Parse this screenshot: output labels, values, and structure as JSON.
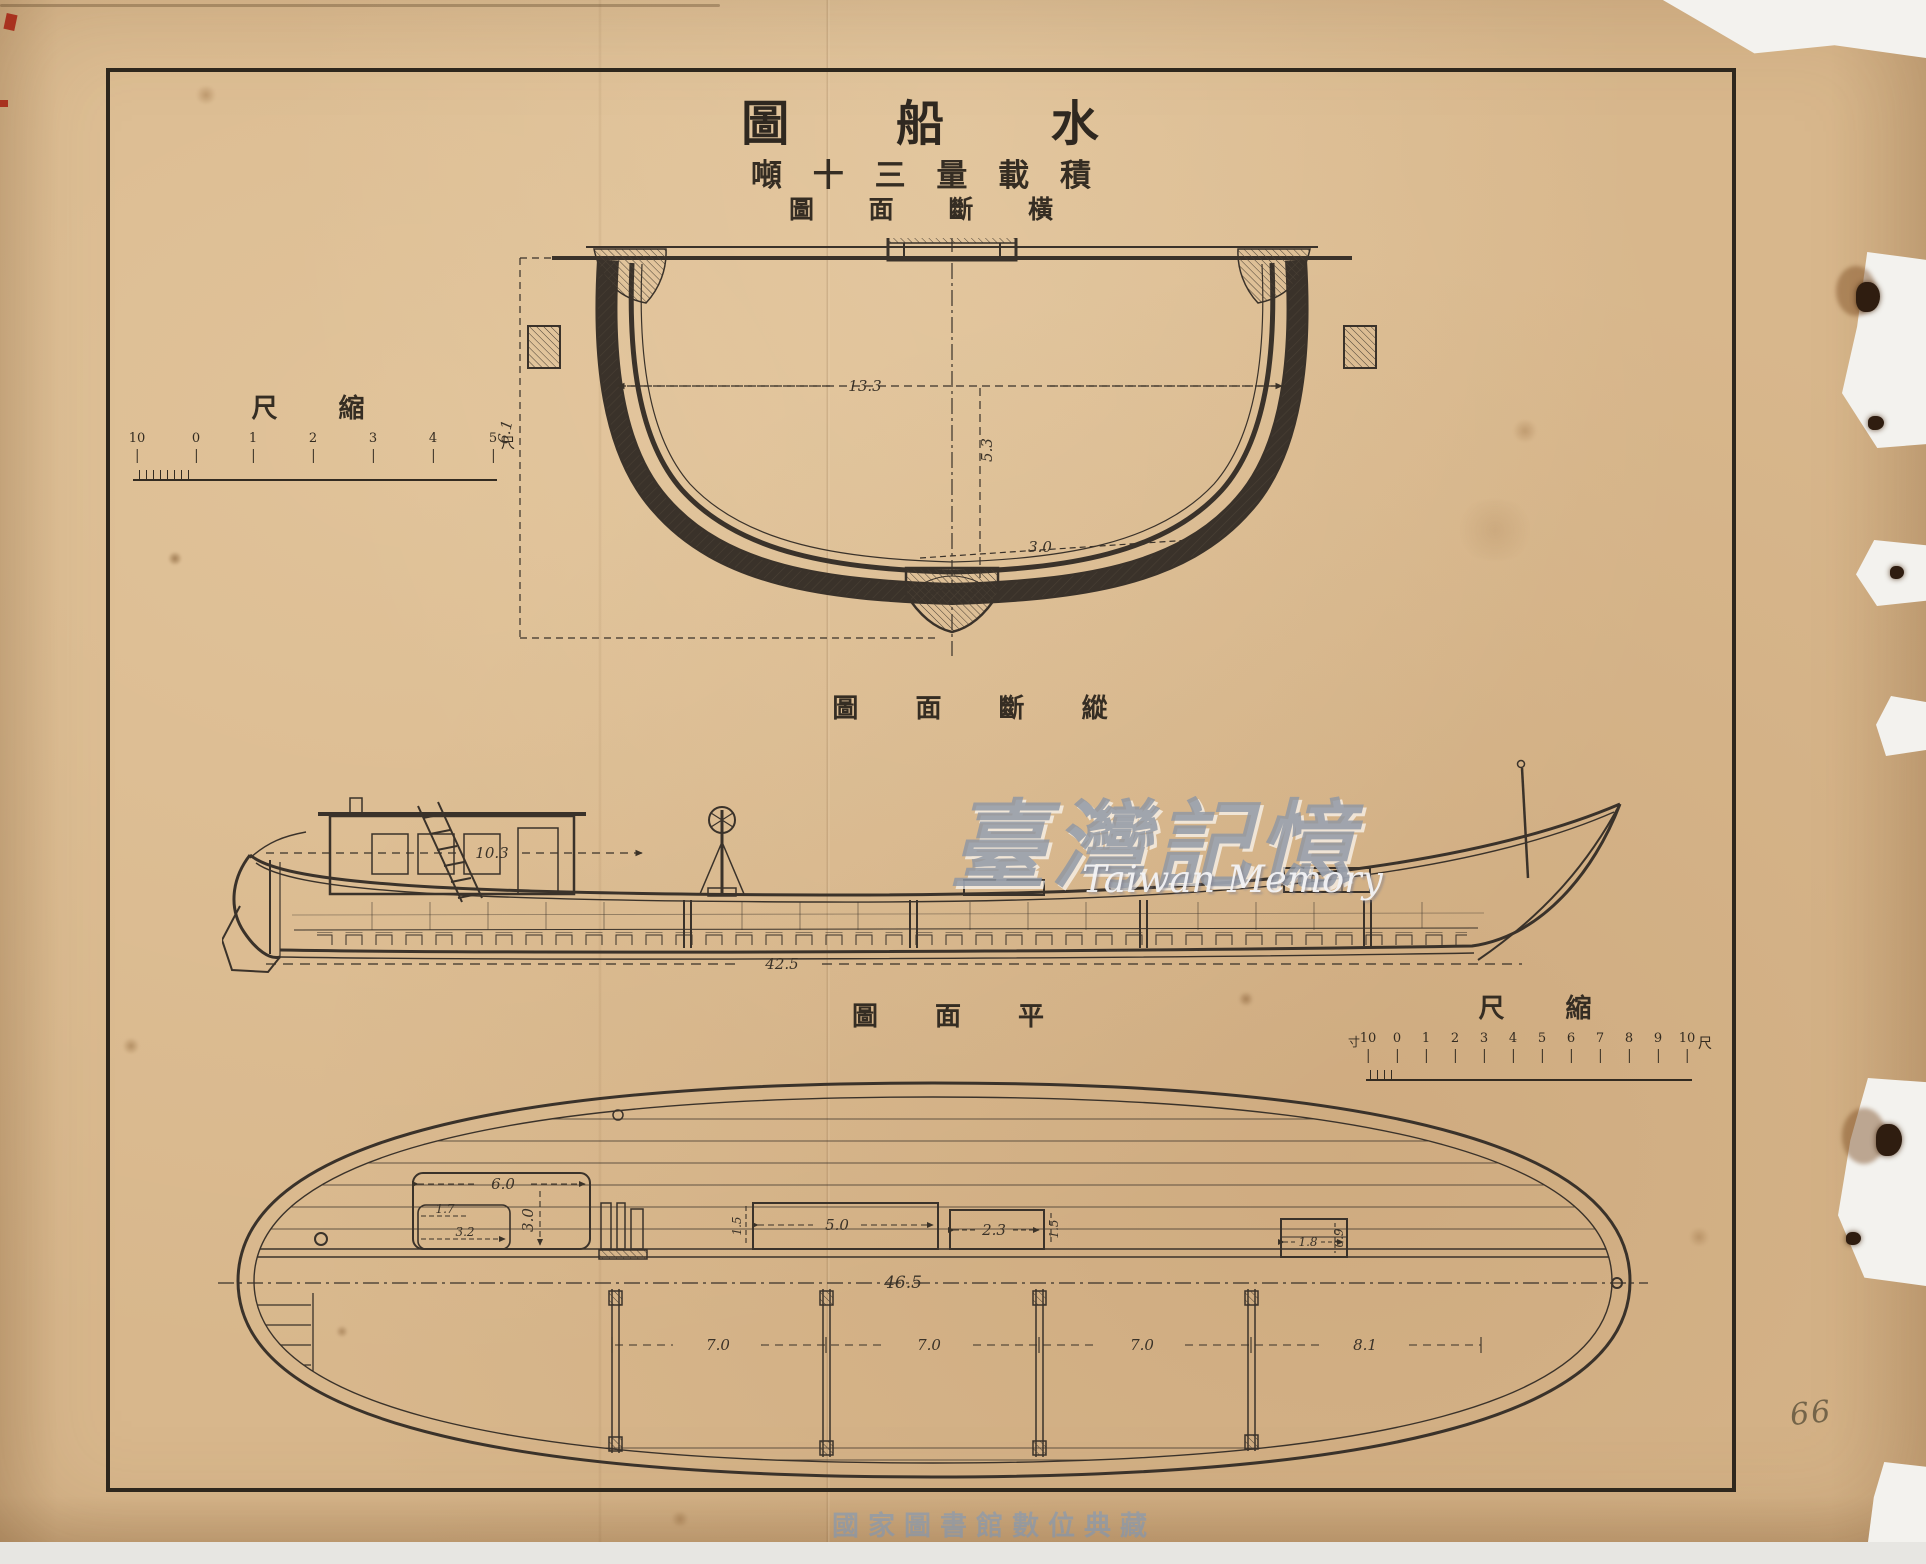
{
  "colors": {
    "paper": "#d8b78c",
    "ink": "#332b21",
    "watermark_gray": "#8e96a4",
    "watermark_blue": "#6e96c8",
    "stamp_red": "#a8321f"
  },
  "titles": {
    "main": "圖 船 水",
    "subtitle": "噸 十 三 量 載 積",
    "cross_section": "圖 面 斷 橫",
    "longitudinal_section": "圖 面 斷 縱",
    "plan": "圖 面 平"
  },
  "rulers": {
    "left": {
      "label": "尺 縮",
      "ticks": [
        "10",
        "0",
        "1",
        "2",
        "3",
        "4",
        "5"
      ],
      "unit_end": "尺"
    },
    "right": {
      "label": "尺 縮",
      "unit_start": "寸",
      "ticks": [
        "10",
        "0",
        "1",
        "2",
        "3",
        "4",
        "5",
        "6",
        "7",
        "8",
        "9",
        "10"
      ],
      "unit_end": "尺"
    }
  },
  "dimensions": {
    "cross": {
      "beam": "13.3",
      "depth": "5.3",
      "bottom": "3.0",
      "height": "6.1"
    },
    "side": {
      "hold_length": "10.3",
      "overall_length": "42.5"
    },
    "plan": {
      "hatch_width": "6.0",
      "hatch_depth": "3.0",
      "locker_width": "1.7",
      "locker_length": "3.2",
      "mid_width": "5.0",
      "mid_depth": "1.5",
      "aft_width": "2.3",
      "aft_depth": "1.5",
      "stern_width": "1.8",
      "stern_depth": "0.9",
      "overall": "46.5",
      "bay_1": "7.0",
      "bay_2": "7.0",
      "bay_3": "7.0",
      "bay_4": "8.1"
    }
  },
  "watermarks": {
    "taiwan_memory_cjk": "臺灣記憶",
    "taiwan_memory_en": "Taiwan Memory",
    "library": "國家圖書館數位典藏"
  },
  "annotations": {
    "page_number": "66"
  }
}
